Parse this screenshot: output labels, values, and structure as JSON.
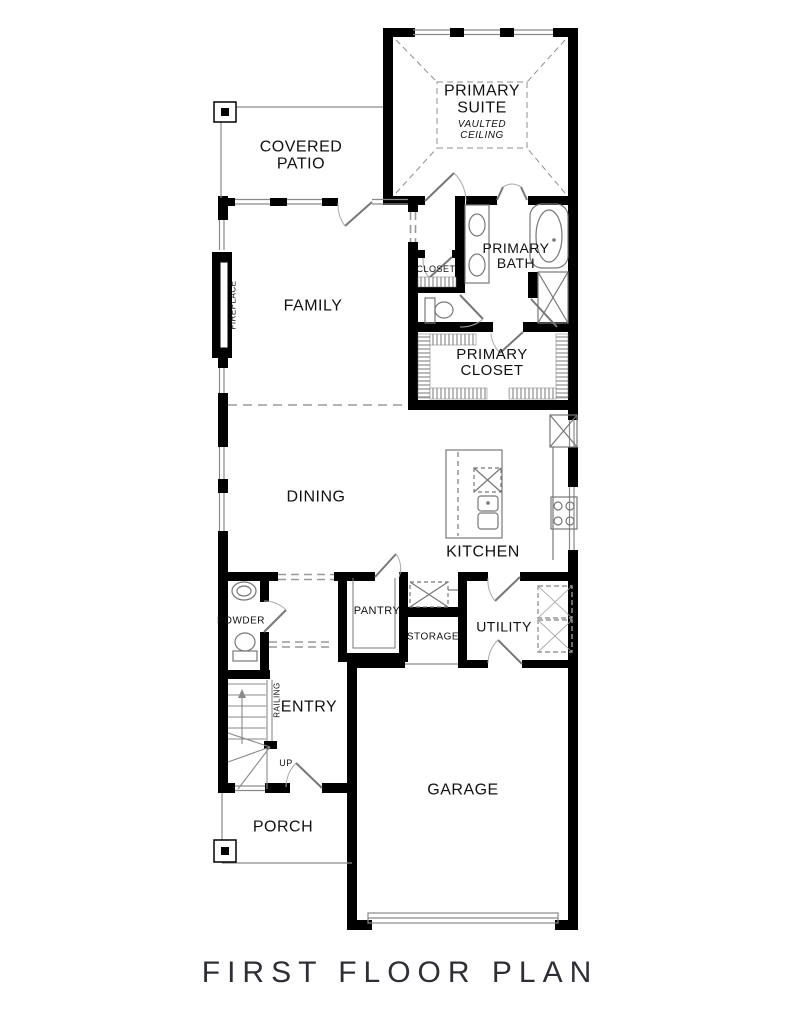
{
  "title": {
    "text": "FIRST FLOOR PLAN"
  },
  "rooms": {
    "primary_suite": {
      "label": "PRIMARY SUITE",
      "ceiling_note": "VAULTED CEILING"
    },
    "covered_patio": {
      "label": "COVERED PATIO"
    },
    "family": {
      "label": "FAMILY"
    },
    "primary_bath": {
      "label": "PRIMARY BATH"
    },
    "closet": {
      "label": "CLOSET"
    },
    "primary_closet": {
      "label": "PRIMARY CLOSET"
    },
    "dining": {
      "label": "DINING"
    },
    "kitchen": {
      "label": "KITCHEN"
    },
    "powder": {
      "label": "POWDER"
    },
    "pantry": {
      "label": "PANTRY"
    },
    "storage": {
      "label": "STORAGE"
    },
    "utility": {
      "label": "UTILITY"
    },
    "entry": {
      "label": "ENTRY"
    },
    "porch": {
      "label": "PORCH"
    },
    "garage": {
      "label": "GARAGE"
    }
  },
  "annotations": {
    "fireplace": "FIREPLACE",
    "railing": "RAILING",
    "stairs_up": "UP"
  },
  "colors": {
    "walls": "#000000",
    "thin_lines": "#8a8a8a",
    "dashed_lines": "#999999",
    "text": "#111111",
    "title_text": "#2e2e36",
    "background": "#ffffff"
  }
}
